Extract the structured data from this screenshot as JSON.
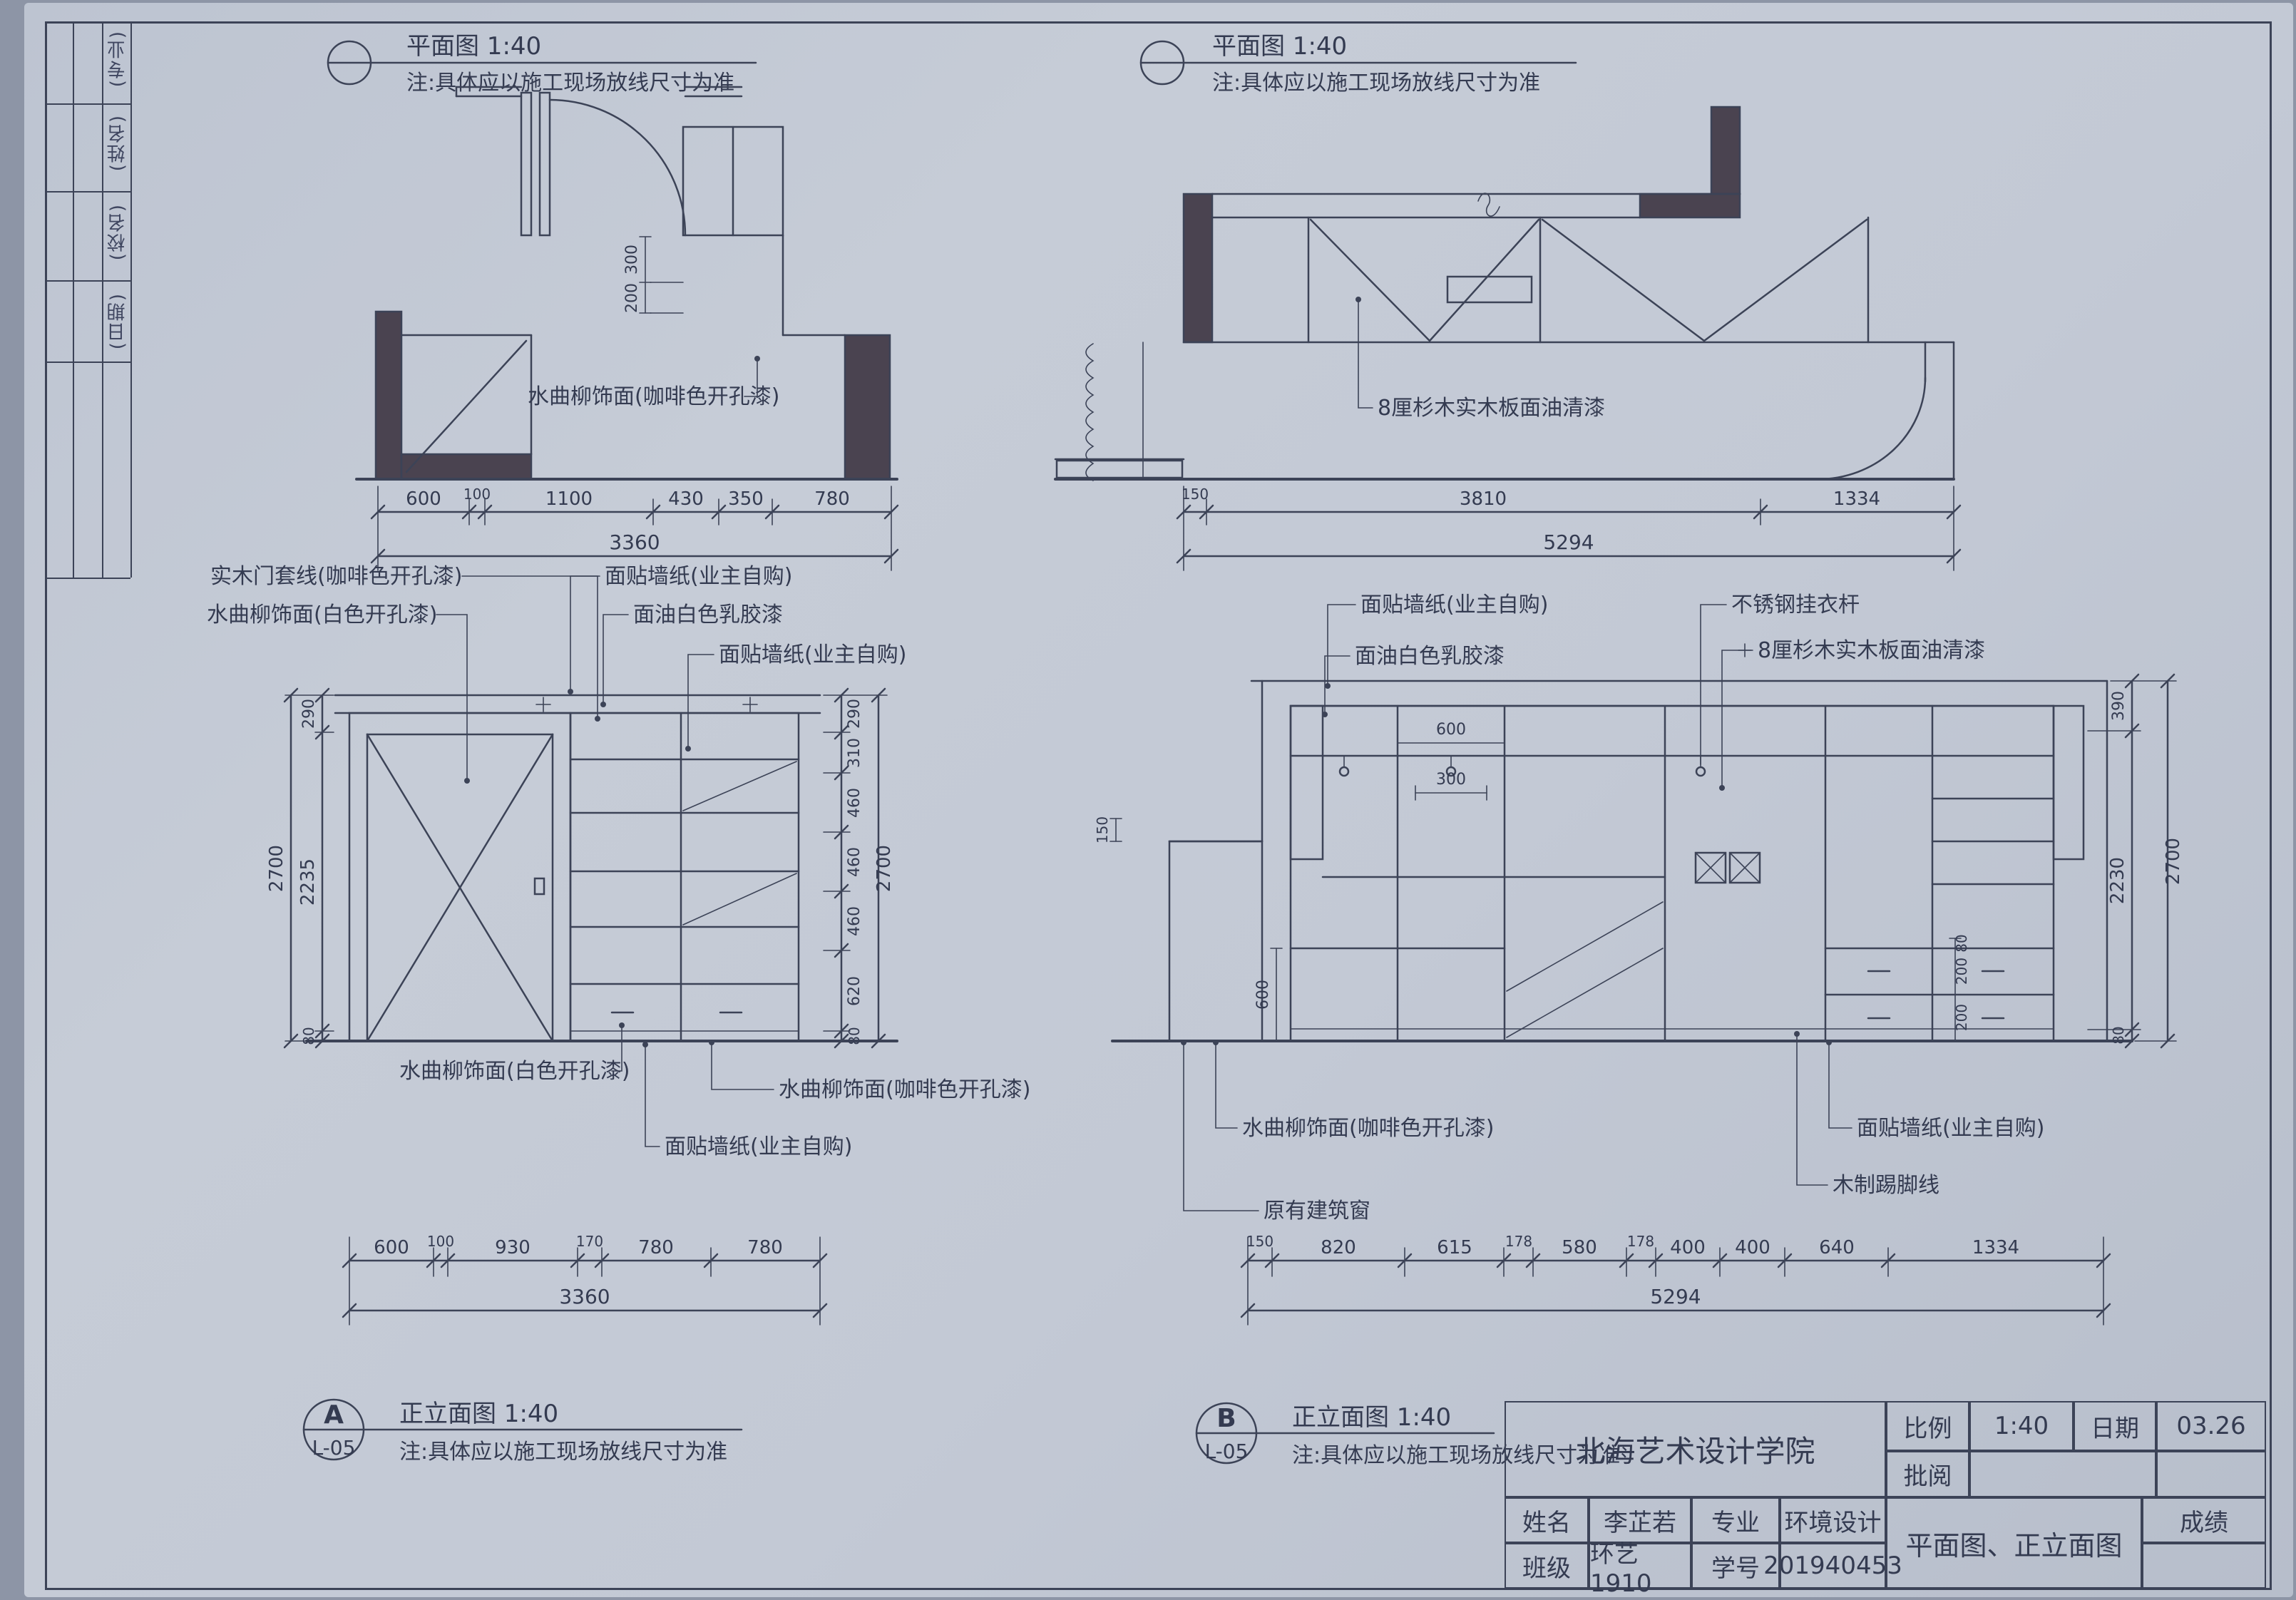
{
  "sheet": {
    "bg": "#c3c9d5",
    "ink": "#3c4357",
    "wall_fill": "#4a4350"
  },
  "edge_strip": {
    "cells": [
      "(专业)",
      "(姓名)",
      "(校名)",
      "(日期)"
    ]
  },
  "plan_left": {
    "title": "平面图 1:40",
    "note": "注:具体应以施工现场放线尺寸为准",
    "label_finish": "水曲柳饰面(咖啡色开孔漆)",
    "vdims": [
      "300",
      "200"
    ],
    "dims": [
      "600",
      "100",
      "1100",
      "430",
      "350",
      "780"
    ],
    "total": "3360"
  },
  "plan_right": {
    "title": "平面图 1:40",
    "note": "注:具体应以施工现场放线尺寸为准",
    "label_board": "8厘杉木实木板面油清漆",
    "dims": [
      "150",
      "3810",
      "1334"
    ],
    "total": "5294"
  },
  "elev_left": {
    "tag": "A",
    "sheet_no": "L-05",
    "title": "正立面图 1:40",
    "note": "注:具体应以施工现场放线尺寸为准",
    "label_door_trim": "实木门套线(咖啡色开孔漆)",
    "label_ash_white": "水曲柳饰面(白色开孔漆)",
    "label_wallpaper_1": "面贴墙纸(业主自购)",
    "label_white_paint": "面油白色乳胶漆",
    "label_wallpaper_2": "面贴墙纸(业主自购)",
    "label_ash_white_b": "水曲柳饰面(白色开孔漆)",
    "label_ash_coffee_b": "水曲柳饰面(咖啡色开孔漆)",
    "label_wallpaper_b": "面贴墙纸(业主自购)",
    "vdims_left": [
      "290",
      "2235",
      "80",
      "2700"
    ],
    "vdims_right": [
      "290",
      "310",
      "460",
      "460",
      "460",
      "620",
      "80",
      "2700"
    ],
    "dims": [
      "600",
      "100",
      "930",
      "170",
      "780",
      "780"
    ],
    "total": "3360"
  },
  "elev_right": {
    "tag": "B",
    "sheet_no": "L-05",
    "title": "正立面图 1:40",
    "note": "注:具体应以施工现场放线尺寸为准",
    "label_wallpaper": "面贴墙纸(业主自购)",
    "label_white_paint": "面油白色乳胶漆",
    "label_rail": "不锈钢挂衣杆",
    "label_board": "8厘杉木实木板面油清漆",
    "label_ash_coffee": "水曲柳饰面(咖啡色开孔漆)",
    "label_window": "原有建筑窗",
    "label_wallpaper_b": "面贴墙纸(业主自购)",
    "label_skirting": "木制踢脚线",
    "vdims_left": [
      "150",
      "600"
    ],
    "vdims_right": [
      "390",
      "2230",
      "80",
      "2700"
    ],
    "inner_dims": [
      "600",
      "300",
      "80",
      "200",
      "200"
    ],
    "dims": [
      "150",
      "820",
      "615",
      "178",
      "580",
      "178",
      "400",
      "400",
      "640",
      "1334"
    ],
    "total": "5294"
  },
  "titleblock": {
    "school": "北海艺术设计学院",
    "scale_label": "比例",
    "scale_value": "1:40",
    "date_label": "日期",
    "date_value": "03.26",
    "review_label": "批阅",
    "name_label": "姓名",
    "name_value": "李芷若",
    "major_label": "专业",
    "major_value": "环境设计",
    "class_label": "班级",
    "class_value": "环艺1910",
    "id_label": "学号",
    "id_value": "201940453",
    "project_label": "平面图、正立面图",
    "grade_label": "成绩"
  }
}
